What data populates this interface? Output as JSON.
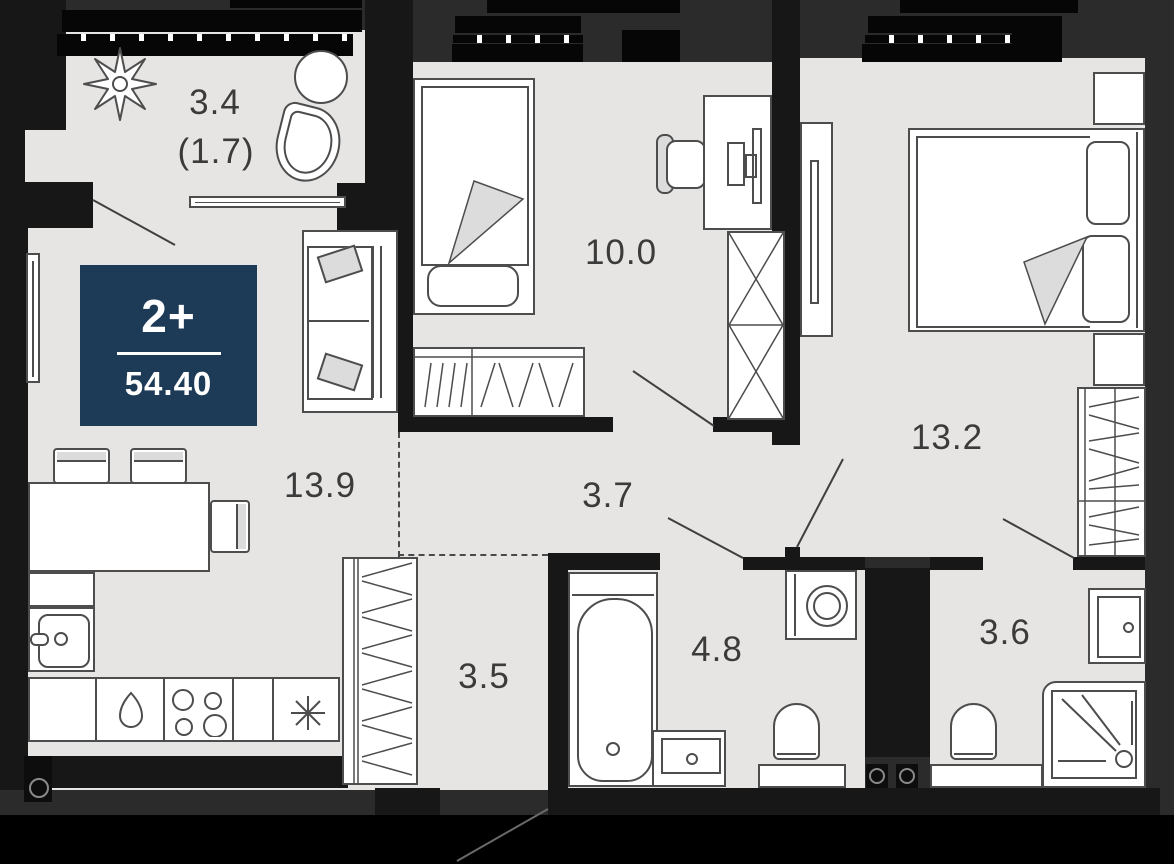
{
  "plan": {
    "type": "apartment-floor-plan",
    "badge": {
      "rooms_label": "2+",
      "total_area": "54.40"
    },
    "rooms": {
      "balcony": {
        "area": "3.4",
        "area_included": "(1.7)"
      },
      "bedroom": {
        "area": "10.0"
      },
      "master_bedroom": {
        "area": "13.2"
      },
      "kitchen_living": {
        "area": "13.9"
      },
      "hallway": {
        "area": "3.7"
      },
      "corridor": {
        "area": "3.5"
      },
      "bathroom": {
        "area": "4.8"
      },
      "shower_room": {
        "area": "3.6"
      }
    },
    "icons": {
      "hob_symbol": "four-burner-circles",
      "extractor_symbol": "asterisk-star",
      "water_drop_symbol": "teardrop",
      "vent_shaft_symbol": "circle-in-square"
    },
    "colors": {
      "badge_bg": "#1d3a57",
      "floor": "#e6e5e3",
      "wall": "#171717",
      "background": "#2b2b2b",
      "furniture_line": "#4d4d4d"
    }
  }
}
